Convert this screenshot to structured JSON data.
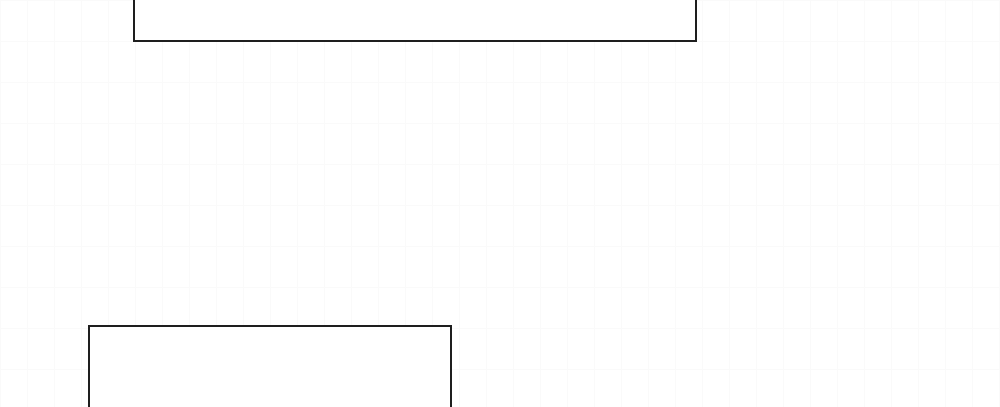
{
  "canvas": {
    "width": 1000,
    "height": 407,
    "background_color": "#ffffff",
    "faint_grid_color": "#fafafa",
    "faint_grid_spacing_x": 27,
    "faint_grid_spacing_y": 41
  },
  "boxes": [
    {
      "name": "top-outlined-box",
      "left": 133,
      "top": -12,
      "width": 564,
      "height": 54,
      "border_color": "#1e1e1e",
      "border_width": 2,
      "fill_color": "#ffffff",
      "clipped_edge": "top",
      "text": ""
    },
    {
      "name": "bottom-left-outlined-box",
      "left": 88,
      "top": 325,
      "width": 364,
      "height": 94,
      "border_color": "#1e1e1e",
      "border_width": 2,
      "fill_color": "#ffffff",
      "clipped_edge": "bottom",
      "text": ""
    }
  ]
}
